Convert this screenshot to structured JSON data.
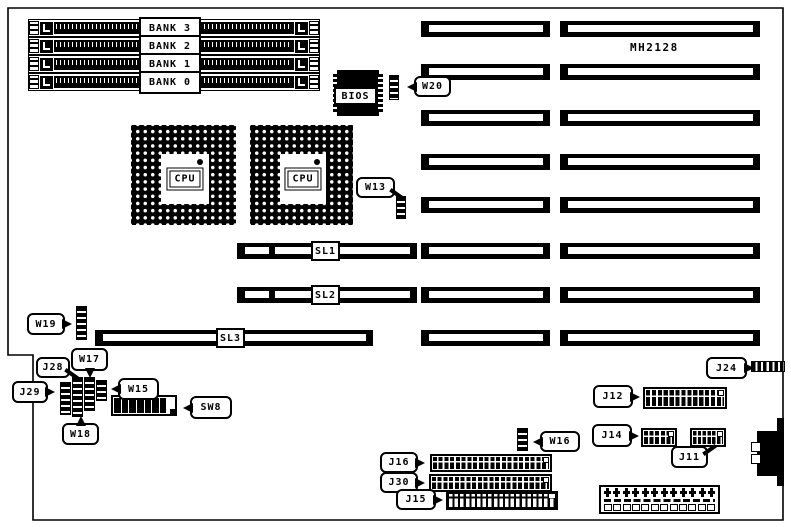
{
  "board": {
    "model": "MH2128"
  },
  "memory_banks": [
    {
      "label": "BANK 3"
    },
    {
      "label": "BANK 2"
    },
    {
      "label": "BANK 1"
    },
    {
      "label": "BANK 0"
    }
  ],
  "cpu_sockets": [
    {
      "label": "CPU"
    },
    {
      "label": "CPU"
    }
  ],
  "bios": {
    "label": "BIOS"
  },
  "slots": [
    {
      "label": "SL1"
    },
    {
      "label": "SL2"
    },
    {
      "label": "SL3"
    }
  ],
  "jumpers": {
    "w13": "W13",
    "w15": "W15",
    "w16": "W16",
    "w17": "W17",
    "w18": "W18",
    "w19": "W19",
    "w20": "W20"
  },
  "connectors": {
    "j11": "J11",
    "j12": "J12",
    "j14": "J14",
    "j15": "J15",
    "j16": "J16",
    "j24": "J24",
    "j28": "J28",
    "j29": "J29",
    "j30": "J30"
  },
  "switches": {
    "sw8": "SW8"
  },
  "colors": {
    "ink": "#000000",
    "paper": "#ffffff"
  }
}
